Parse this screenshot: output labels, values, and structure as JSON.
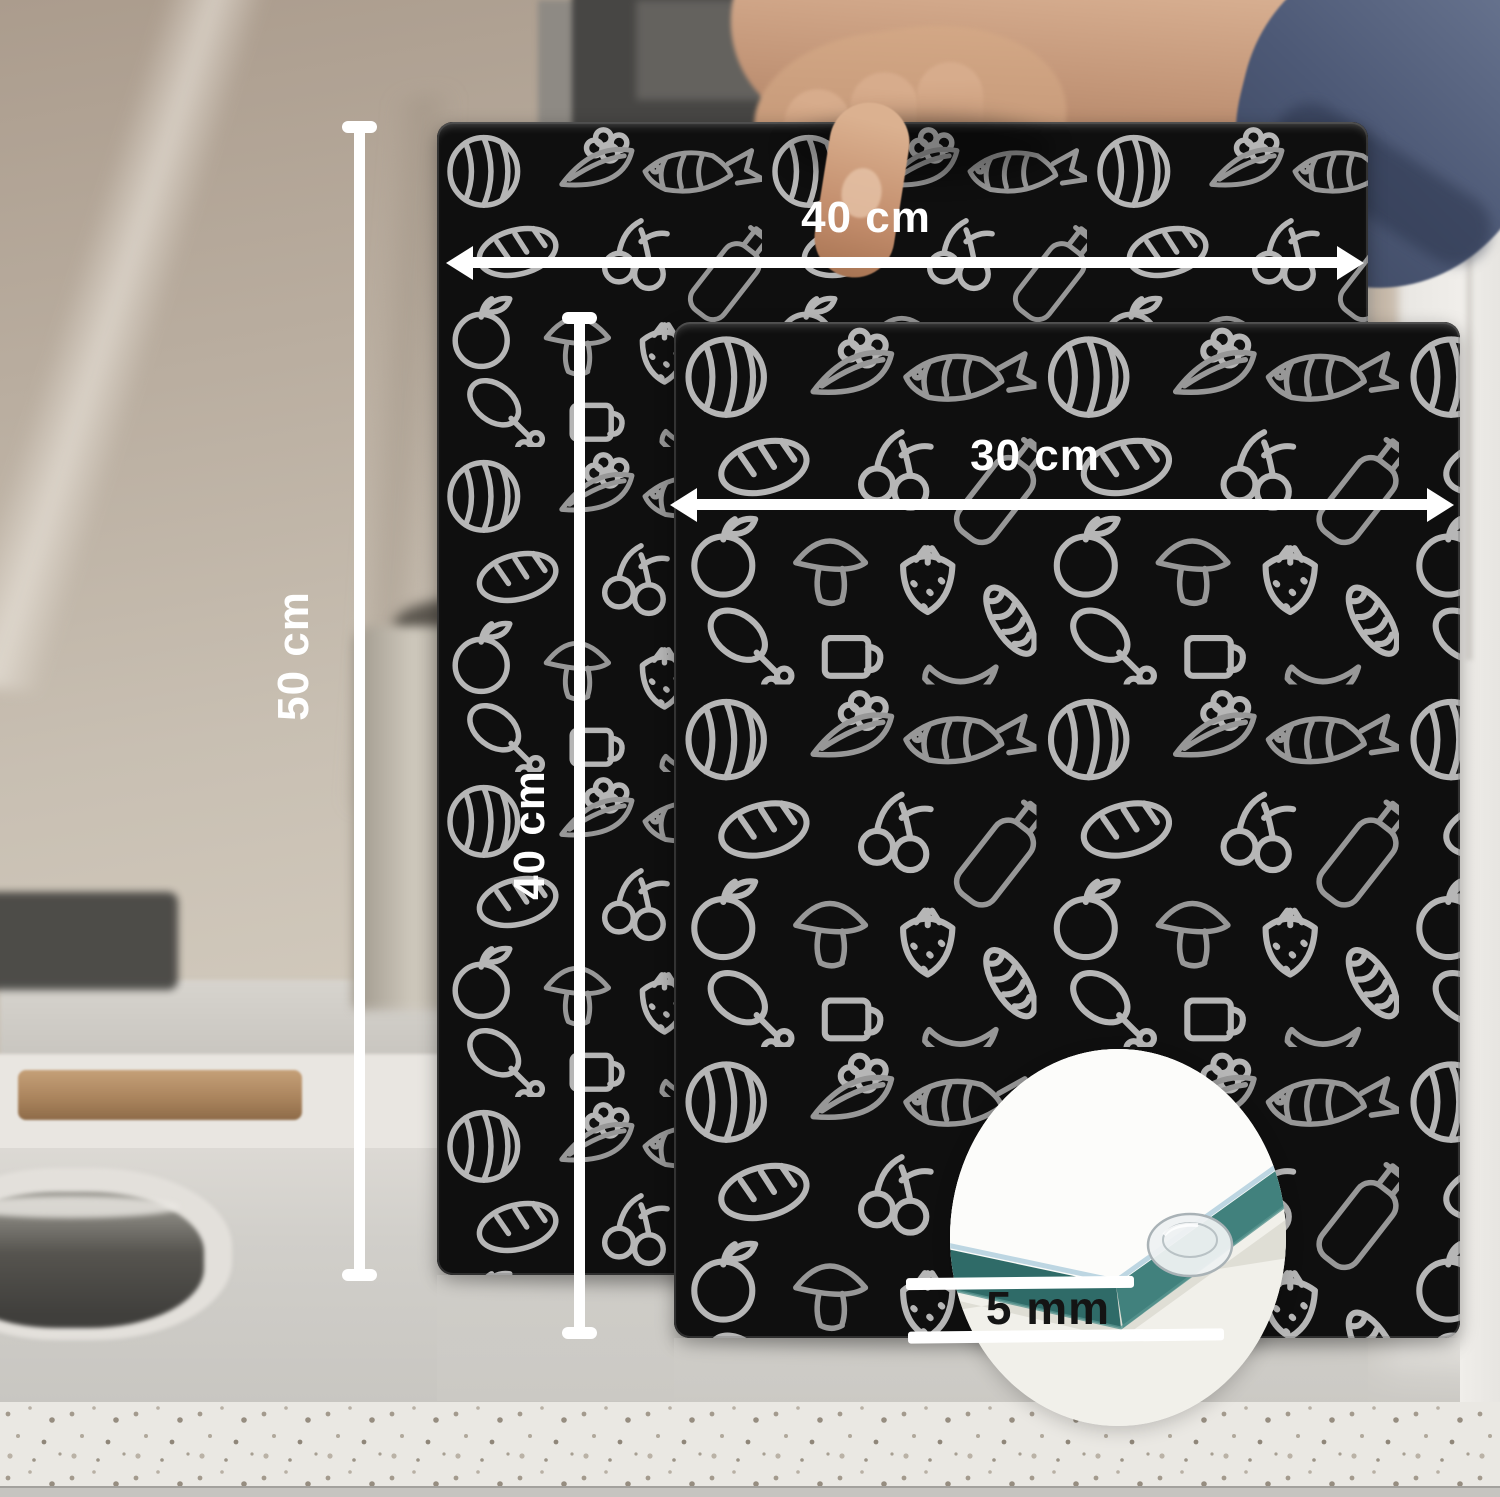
{
  "annotations": {
    "large_board_width": "40 cm",
    "large_board_height": "50 cm",
    "small_board_width": "30 cm",
    "small_board_height": "40 cm",
    "board_thickness": "5 mm"
  },
  "colors": {
    "annotation_text": "#ffffff",
    "thickness_text": "#141414",
    "board_black": "#0d0d0d",
    "doodle_gray": "#b2b2b2",
    "board_edge_teal": "#3c7a77",
    "sleeve_navy": "#4d5976",
    "countertop": "#d1cfca"
  }
}
